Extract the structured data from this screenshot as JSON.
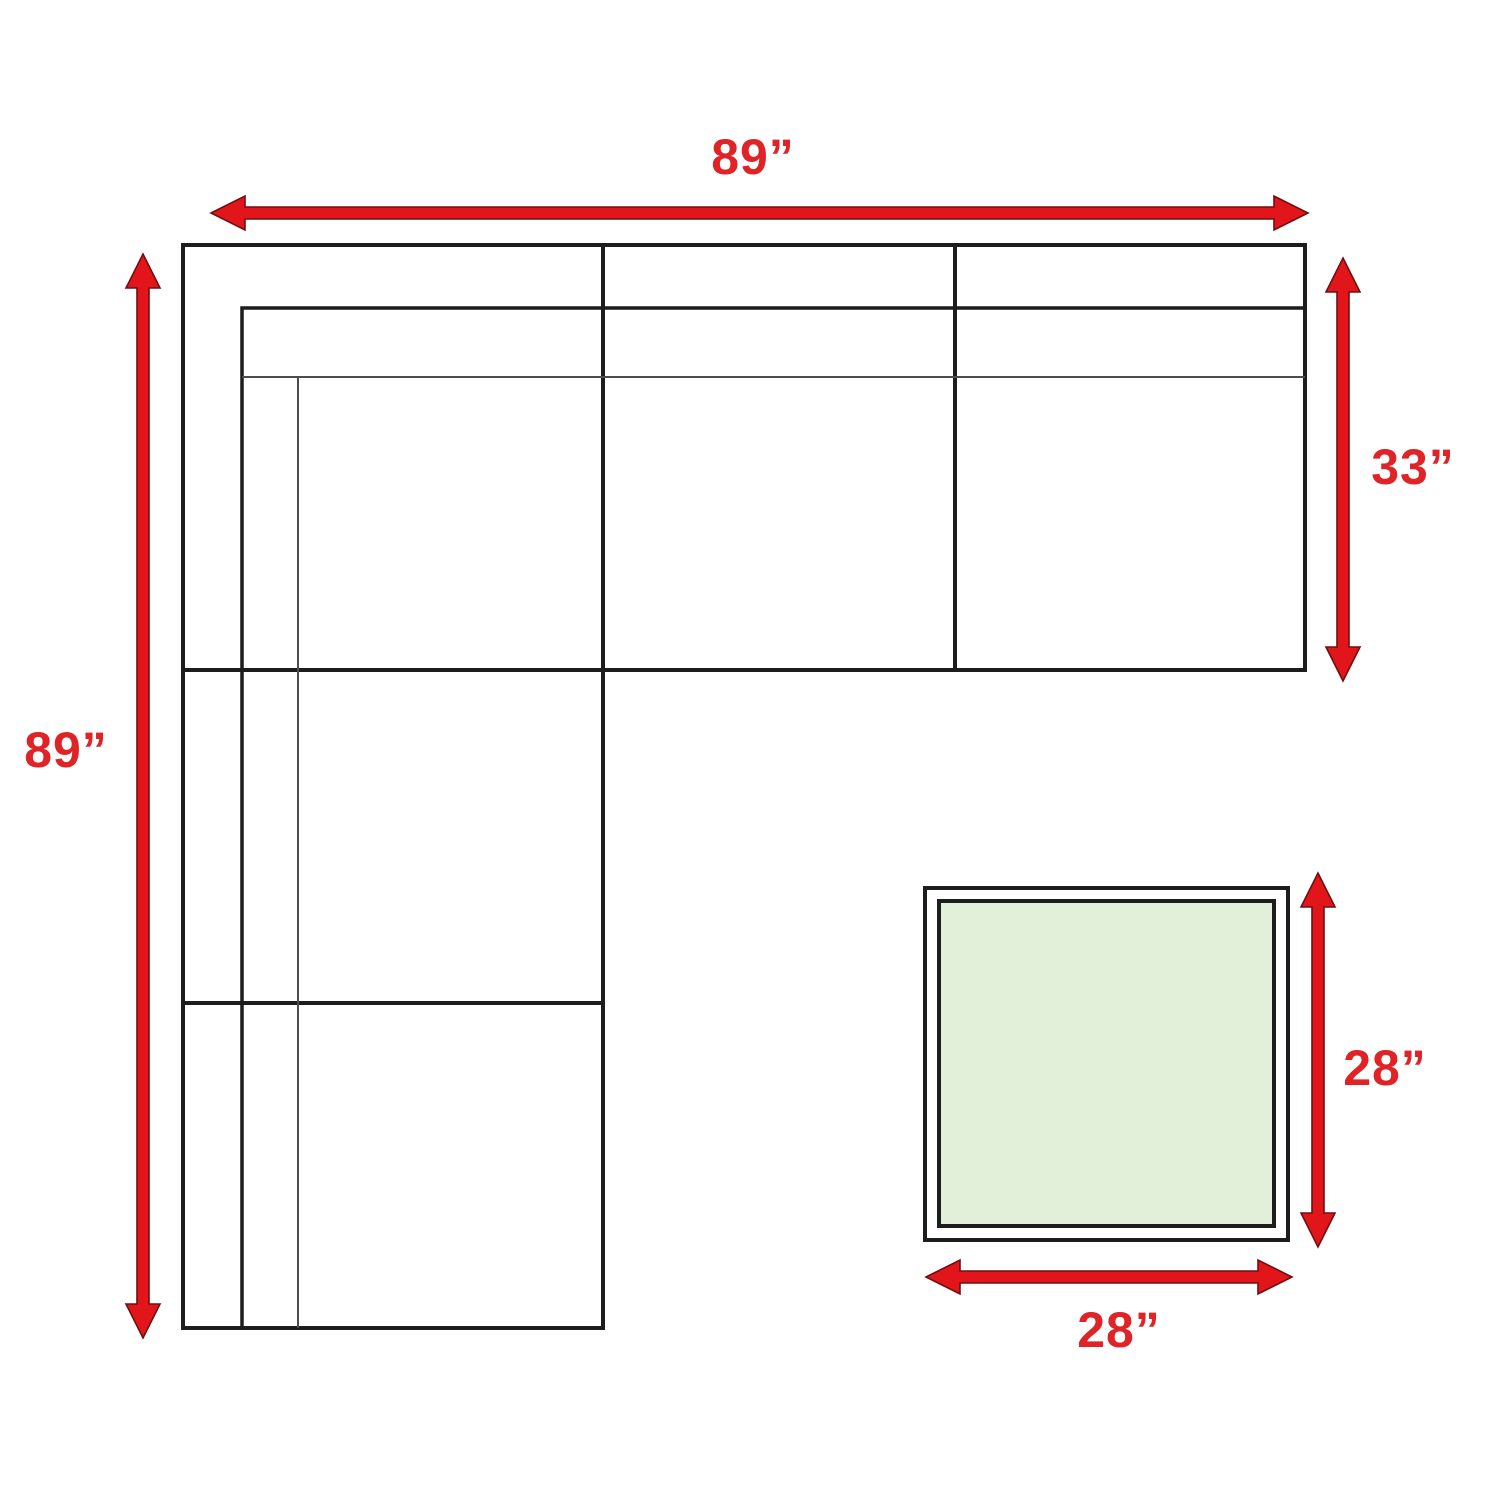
{
  "diagram": {
    "kind": "sectional-sofa-dimension-diagram",
    "labels": {
      "sofa_width": "89”",
      "sofa_height": "89”",
      "sofa_right_depth": "33”",
      "ottoman_depth": "28”",
      "ottoman_width": "28”"
    },
    "colors": {
      "arrow": "#e2151b",
      "arrow_edge": "#6e1012",
      "label_text": "#df2326",
      "outline": "#1d1d1d",
      "thin_line": "#4d4d4d",
      "ottoman_fill": "#e2efd9",
      "background": "#ffffff"
    }
  }
}
